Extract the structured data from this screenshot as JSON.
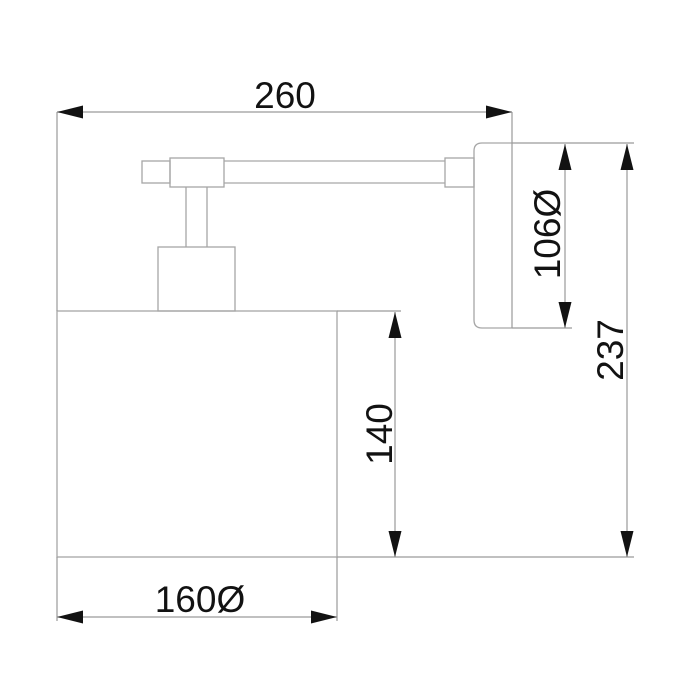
{
  "title": "Wall lamp technical dimension drawing",
  "drawing": {
    "subject": "wall-mounted lamp, side elevation view",
    "colors": {
      "background": "#ffffff",
      "outline": "#a6a6a6",
      "dimension_lines": "#9a9a9a",
      "text_and_arrows": "#121212"
    },
    "parts": [
      "lamp shade",
      "lamp socket",
      "stem",
      "arm joint",
      "arm end cap",
      "horizontal arm",
      "wall connector",
      "wall backplate"
    ],
    "dimensions": [
      {
        "name": "overall-width",
        "label": "260",
        "value": 260,
        "orientation": "horizontal"
      },
      {
        "name": "backplate-diameter",
        "label": "106Ø",
        "value": 106,
        "orientation": "vertical"
      },
      {
        "name": "overall-height",
        "label": "237",
        "value": 237,
        "orientation": "vertical"
      },
      {
        "name": "shade-height",
        "label": "140",
        "value": 140,
        "orientation": "vertical"
      },
      {
        "name": "shade-diameter",
        "label": "160Ø",
        "value": 160,
        "orientation": "horizontal"
      }
    ]
  }
}
